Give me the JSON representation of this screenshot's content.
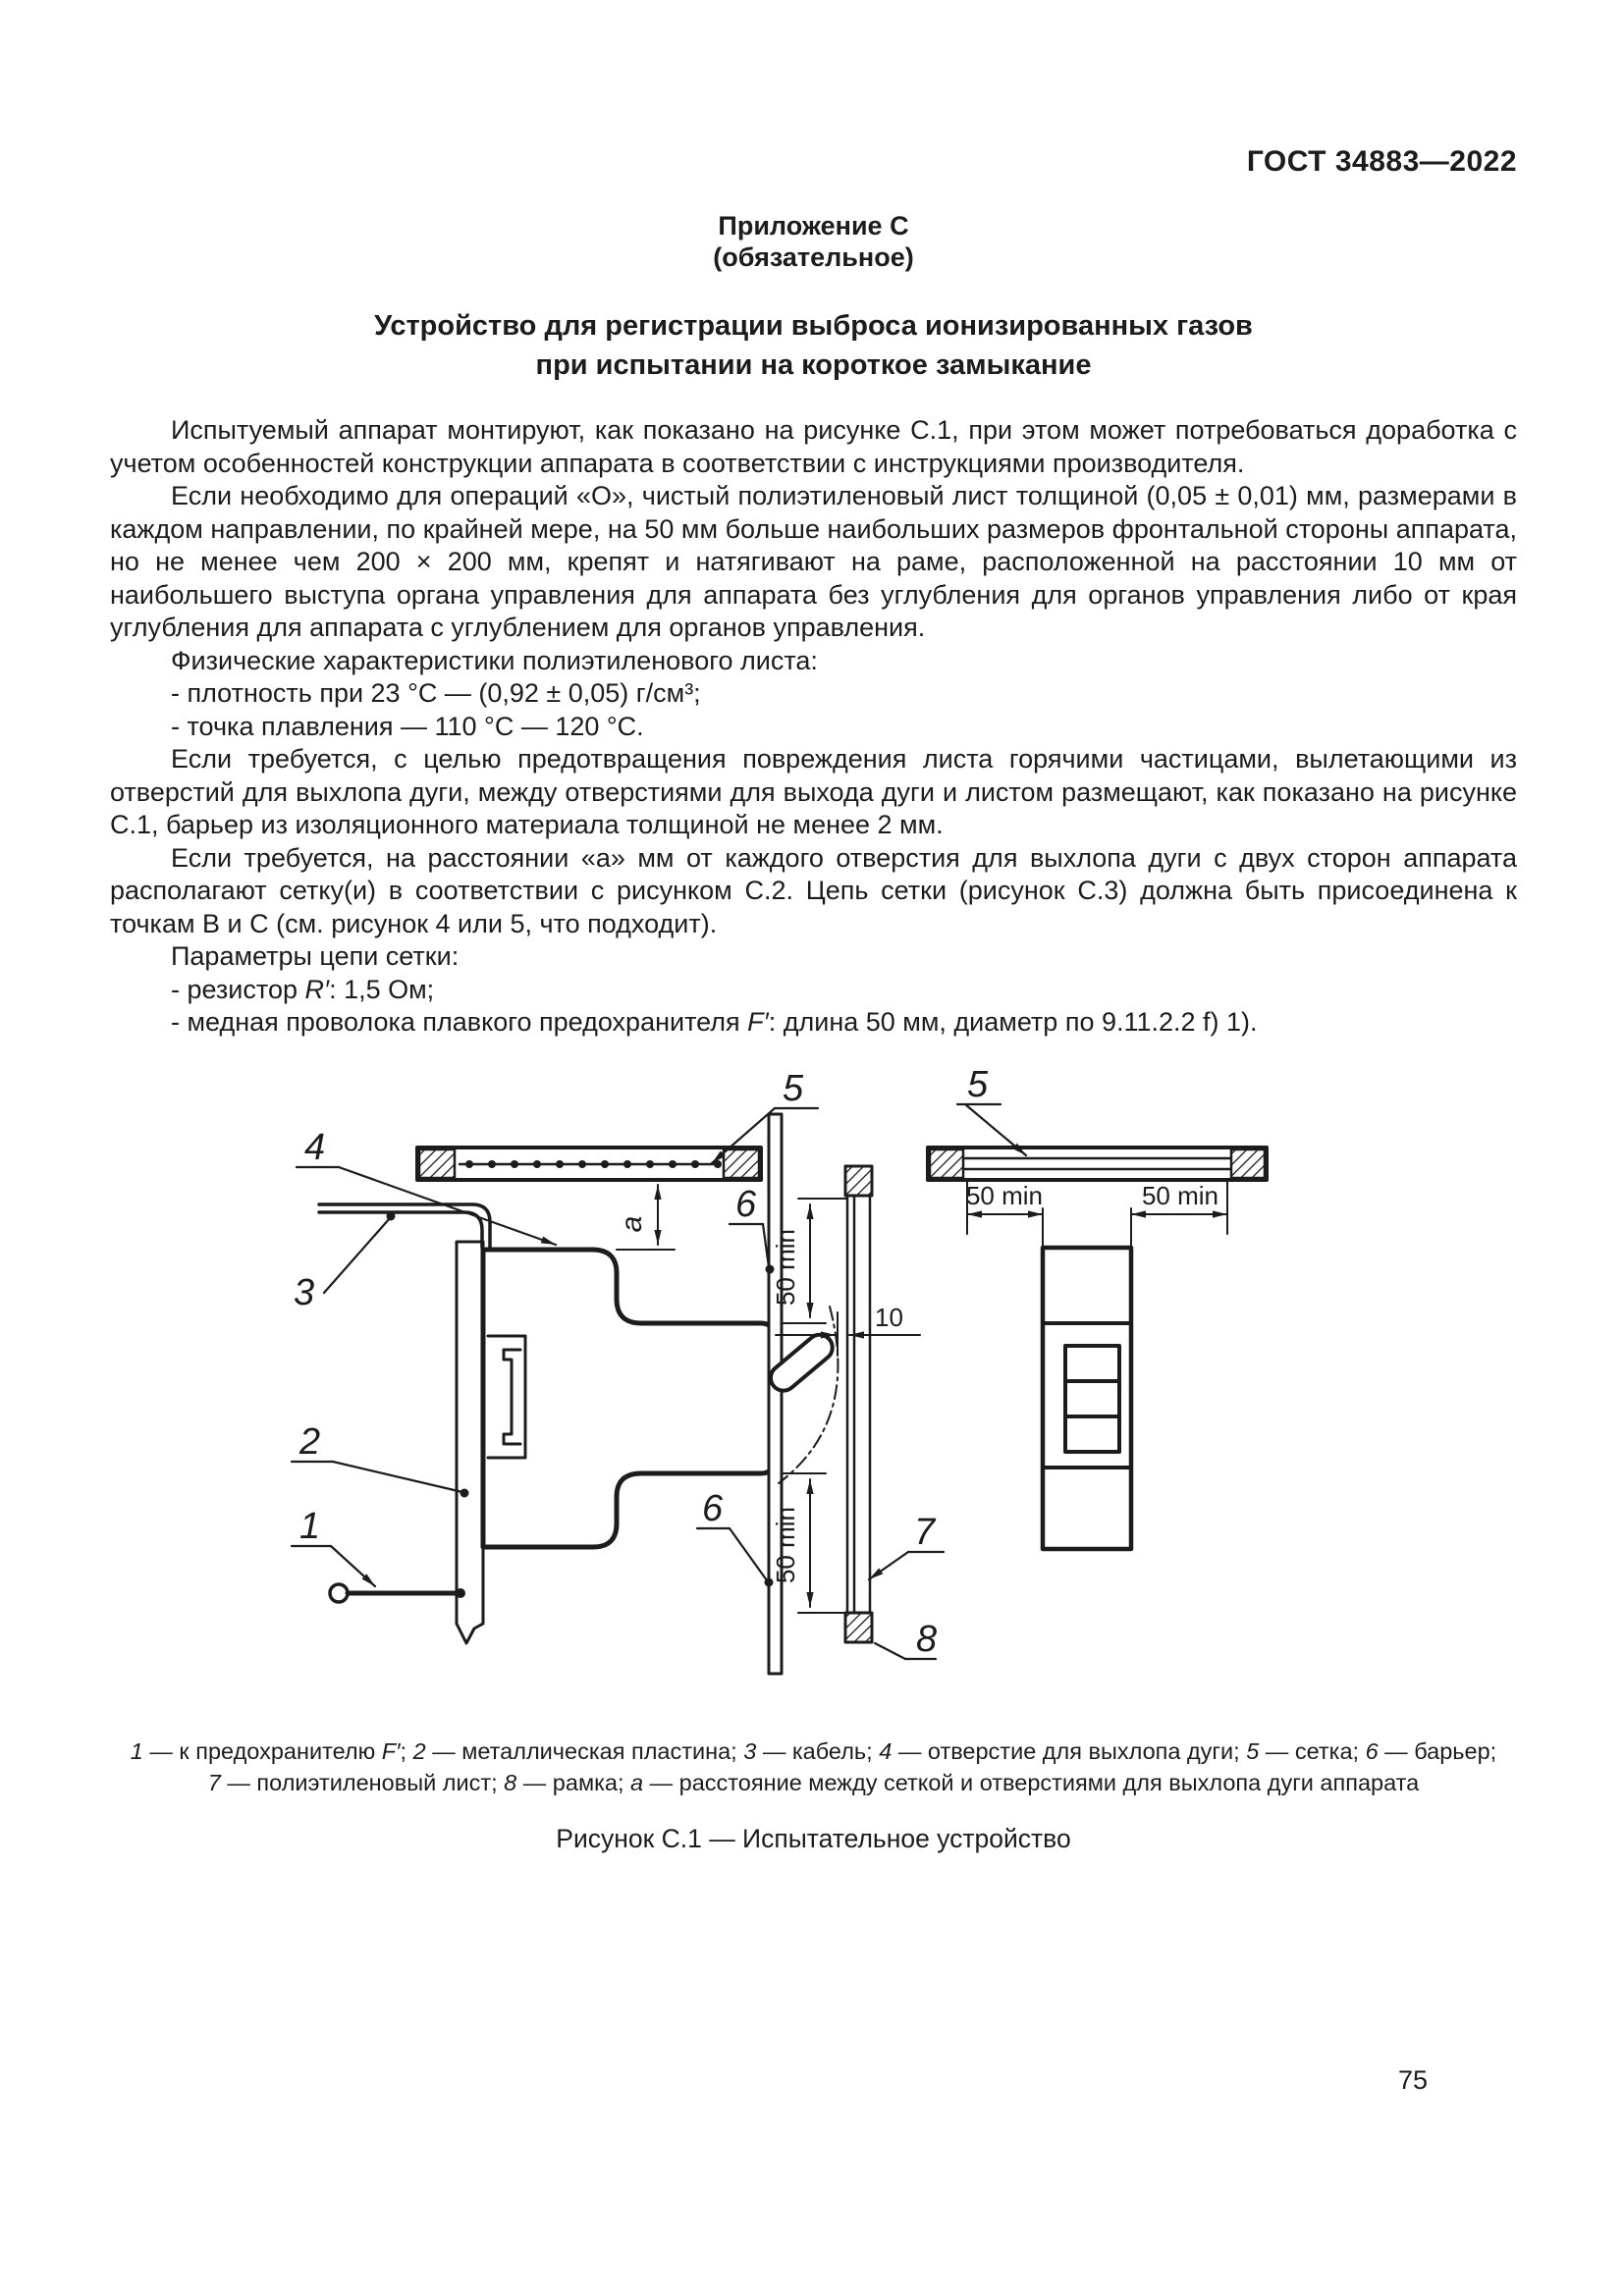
{
  "theme": {
    "ink": "#1c1c1c",
    "paper": "#ffffff"
  },
  "header": {
    "doc_code": "ГОСТ 34883—2022"
  },
  "appendix": {
    "label": "Приложение С",
    "note": "(обязательное)"
  },
  "title": {
    "line1": "Устройство для регистрации выброса ионизированных газов",
    "line2": "при испытании на короткое замыкание"
  },
  "content": {
    "p1": "Испытуемый аппарат монтируют, как показано на рисунке С.1, при этом может потребоваться доработка с учетом особенностей конструкции аппарата в соответствии с инструкциями производителя.",
    "p2": "Если необходимо для операций «О», чистый полиэтиленовый лист толщиной (0,05 ± 0,01) мм, размерами в каждом направлении, по крайней мере, на 50 мм больше наибольших размеров фронтальной стороны аппарата, но не менее чем 200 × 200 мм, крепят и натягивают на раме, расположенной на расстоянии 10 мм от наибольшего выступа органа управления для аппарата без углубления для органов управления либо от края углубления для аппарата с углублением для органов управления.",
    "p3_lead": "Физические характеристики полиэтиленового листа:",
    "li_density": "- плотность при 23 °С — (0,92 ± 0,05) г/см³;",
    "li_melting": "- точка плавления — 110 °С — 120 °С.",
    "p4": "Если требуется, с целью предотвращения повреждения листа горячими частицами, вылетающими из отверстий для выхлопа дуги, между отверстиями для выхода дуги и листом размещают, как показано на рисунке С.1, барьер из изоляционного материала толщиной не менее 2 мм.",
    "p5": "Если требуется, на расстоянии «а» мм от каждого отверстия для выхлопа дуги с двух сторон аппарата располагают сетку(и) в соответствии с рисунком С.2. Цепь сетки (рисунок С.3) должна быть присоединена к точкам В и С (см. рисунок 4 или 5, что подходит).",
    "p6_lead": "Параметры цепи сетки:",
    "li_resistor_segments": [
      {
        "t": "- резистор ",
        "i": false
      },
      {
        "t": "R′",
        "i": true
      },
      {
        "t": ": 1,5 Ом;",
        "i": false
      }
    ],
    "li_fuse_segments": [
      {
        "t": "- медная проволока плавкого предохранителя ",
        "i": false
      },
      {
        "t": "F′",
        "i": true
      },
      {
        "t": ": длина 50 мм, диаметр по 9.11.2.2 f) 1).",
        "i": false
      }
    ]
  },
  "figure": {
    "callouts": {
      "c1": "1",
      "c2": "2",
      "c3": "3",
      "c4": "4",
      "c5": "5",
      "c6": "6",
      "c7": "7",
      "c8": "8"
    },
    "dimensions": {
      "a": "a",
      "fifty_min": "50 min",
      "ten": "10"
    },
    "caption_line1_segments": [
      {
        "t": "1",
        "i": true
      },
      {
        "t": " — к предохранителю ",
        "i": false
      },
      {
        "t": "F′",
        "i": true
      },
      {
        "t": "; ",
        "i": false
      },
      {
        "t": "2",
        "i": true
      },
      {
        "t": " — металлическая пластина; ",
        "i": false
      },
      {
        "t": "3",
        "i": true
      },
      {
        "t": " — кабель; ",
        "i": false
      },
      {
        "t": "4",
        "i": true
      },
      {
        "t": " — отверстие для выхлопа дуги; ",
        "i": false
      },
      {
        "t": "5",
        "i": true
      },
      {
        "t": " — сетка; ",
        "i": false
      },
      {
        "t": "6",
        "i": true
      },
      {
        "t": " — барьер;",
        "i": false
      }
    ],
    "caption_line2_segments": [
      {
        "t": "7",
        "i": true
      },
      {
        "t": " — полиэтиленовый лист; ",
        "i": false
      },
      {
        "t": "8",
        "i": true
      },
      {
        "t": " — рамка; ",
        "i": false
      },
      {
        "t": "а",
        "i": true
      },
      {
        "t": " — расстояние между сеткой и отверстиями для выхлопа дуги аппарата",
        "i": false
      }
    ],
    "title": "Рисунок С.1 — Испытательное устройство"
  },
  "footer": {
    "page_number": "75"
  }
}
